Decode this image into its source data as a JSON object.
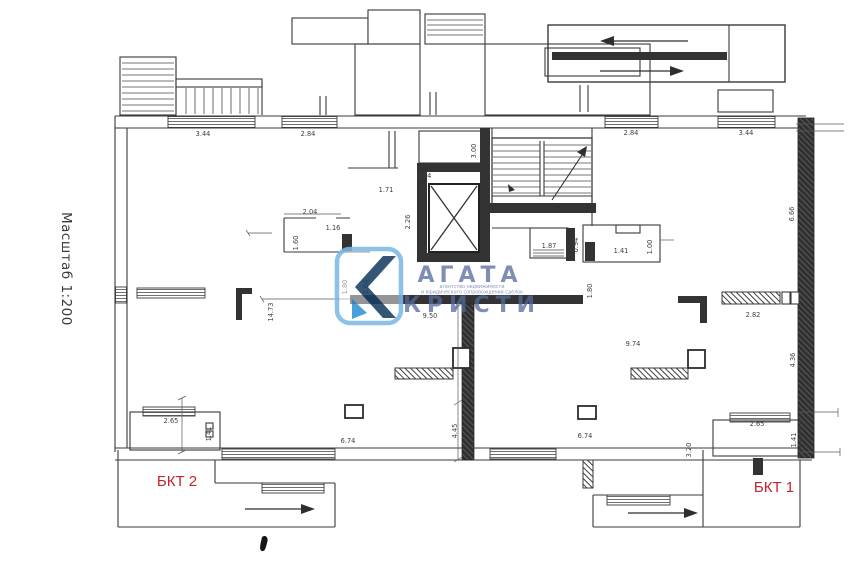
{
  "scale_note": "Масштаб 1:200",
  "unit_labels": {
    "bkt1": "БКТ 1",
    "bkt2": "БКТ 2",
    "label_color": "#c3232b"
  },
  "watermark": {
    "brand_line1": "АГАТА",
    "brand_line2": "КРИСТИ",
    "small_line1": "агентство недвижимости",
    "small_line2": "и юридического сопровождения сделок",
    "logo_letter": "K",
    "brand_color": "#55699e",
    "logo_border_color": "#7db9e8",
    "logo_navy": "#1b3f66",
    "logo_blue": "#2f93d8"
  },
  "drawing": {
    "line_color": "#3a3a3a",
    "wall_fill": "#333333"
  },
  "dims": {
    "top_w1": "3.44",
    "top_w2": "2.84",
    "top_w3": "2.84",
    "top_w4": "3.44",
    "elev_w": "3.74",
    "lobby_w": "1.71",
    "elev_d": "2.26",
    "stair_w": "3.00",
    "room_l_w": "2.04",
    "room_l_d": "1.16",
    "room_l_h": "1.60",
    "room_r1": "1.87",
    "room_r1_d": "0.94",
    "room_r2": "1.41",
    "room_r2_d": "1.00",
    "wall_l_a": "1.80",
    "wall_l_b": "1.64",
    "hall_l_h": "14.73",
    "wall_c": "9.50",
    "wall_c_end": "1.80",
    "hall_r_w": "9.74",
    "wall_r": "2.82",
    "core_h1": "7.54",
    "core_h2": "4.45",
    "win_bl": "6.74",
    "win_br": "6.74",
    "win_br_h": "3.20",
    "entry_l_w": "2.65",
    "entry_l_h": "1.41",
    "entry_r_w": "2.65",
    "entry_r_h": "1.41",
    "wall_r_h1": "6.66",
    "wall_r_h2": "4.36"
  }
}
